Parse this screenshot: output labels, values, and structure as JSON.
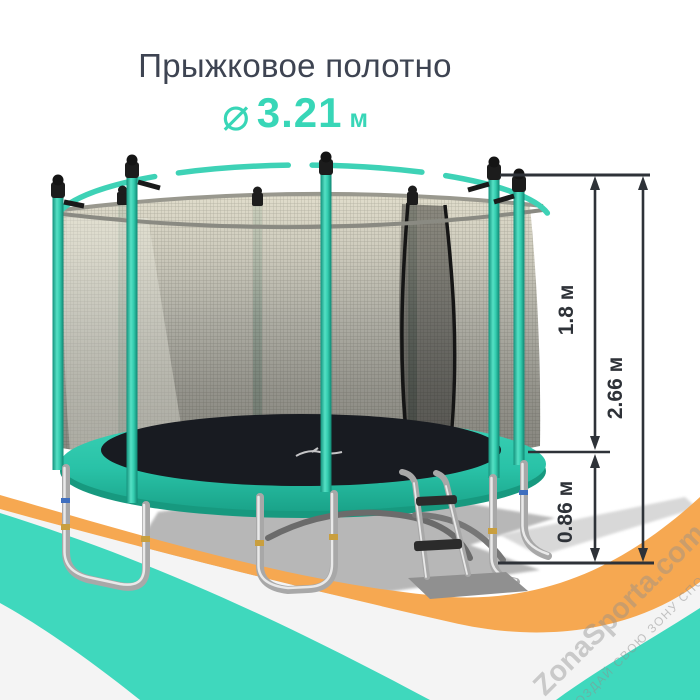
{
  "header": {
    "title": "Прыжковое полотно",
    "diameter": {
      "symbol": "⌀",
      "value": "3.21",
      "unit": "м"
    }
  },
  "dimensions": {
    "net_height": "1.8 м",
    "total_height": "2.66 м",
    "frame_height": "0.86 м"
  },
  "watermark": {
    "brand": "ZonaSporta.com",
    "tagline": "СОЗДАЙ СВОЮ ЗОНУ СПОРТА"
  },
  "colors": {
    "accent_teal": "#38d6b7",
    "title_text": "#3e4452",
    "dimension_lines": "#2e3238",
    "wave_orange": "#f6a851",
    "wave_teal": "#3fd8bd",
    "pad_teal": "#2cc7ab",
    "mat_black": "#181b21",
    "net_gray": "#9b9a8f",
    "chrome": "#b5b5b5",
    "shadow_gray": "#ababab"
  }
}
